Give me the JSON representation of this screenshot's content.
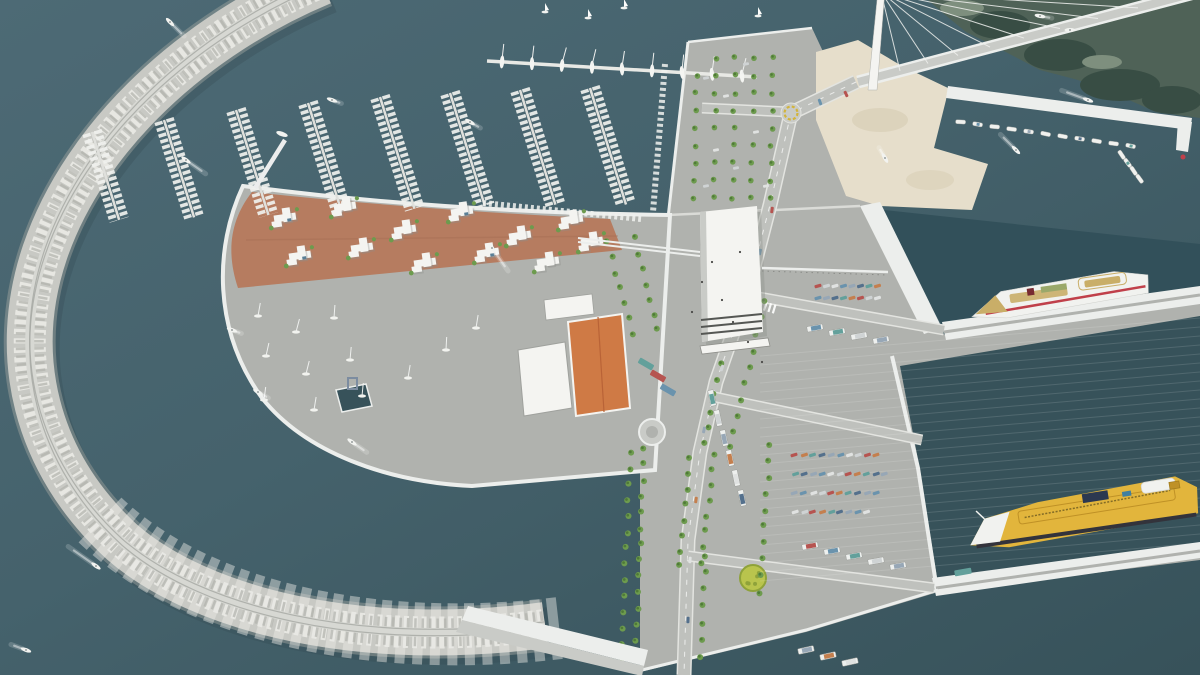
{
  "palette": {
    "water_top": "#4d6a75",
    "water_mid": "#45626c",
    "water_deep": "#37525a",
    "basin": "#32505a",
    "rock_light": "#eaeae6",
    "rock_mid": "#c8c9c4",
    "rock_dark": "#9aa09b",
    "crest": "#d7d8d3",
    "crest_line": "#a5a7a2",
    "quay_white": "#eceeec",
    "concrete": "#b0b2ae",
    "concrete_light": "#c9cbc7",
    "concrete_dark": "#9fa19d",
    "road": "#bfc1bd",
    "curb": "#e3e4e0",
    "sand": "#e6decb",
    "sand_shadow": "#d6cbb2",
    "plaza": "#b67c60",
    "plaza_dark": "#a16a50",
    "white_bld": "#f4f4f1",
    "bld_shadow": "#8f908b",
    "roof_orange": "#cf7a45",
    "roof_orange_dark": "#b96337",
    "tree": "#6d9b4e",
    "tree_dark": "#4f7a38",
    "coast": "#4f6257",
    "coast_dark": "#384d44",
    "coast_light": "#7e8f7e",
    "surf": "#e6eee8",
    "ferry_white": "#f1f2ef",
    "ferry_red": "#c0404a",
    "deck_tan": "#c9ae68",
    "funnel_dark": "#772b31",
    "yellow": "#e2b53c",
    "yellow_dark": "#bf9126",
    "hull_dark": "#33333b",
    "navy": "#2c3850",
    "pool": "#3f7fa0",
    "line_yellow": "#d2b43c",
    "grass": "#b9c44d",
    "grass_dark": "#8fa23a",
    "car_colors": [
      "#b65450",
      "#6a93ad",
      "#63a09b",
      "#cfd3d4",
      "#97a7b6",
      "#c47f4e",
      "#e0e2e1",
      "#54708c"
    ]
  },
  "scene": {
    "water_boats": [
      [
        170,
        22,
        225,
        16
      ],
      [
        332,
        100,
        200,
        6
      ],
      [
        186,
        160,
        215,
        20
      ],
      [
        470,
        122,
        210,
        8
      ],
      [
        492,
        248,
        235,
        24
      ],
      [
        232,
        330,
        200,
        6
      ],
      [
        258,
        392,
        210,
        8
      ],
      [
        352,
        442,
        215,
        14
      ],
      [
        96,
        566,
        35,
        30
      ],
      [
        26,
        650,
        20,
        12
      ],
      [
        1040,
        16,
        190,
        8
      ],
      [
        1070,
        30,
        0,
        0
      ],
      [
        1088,
        100,
        20,
        24
      ],
      [
        1016,
        150,
        45,
        18
      ],
      [
        885,
        158,
        60,
        8
      ]
    ],
    "sailboats": [
      [
        545,
        12
      ],
      [
        588,
        18
      ],
      [
        624,
        8
      ],
      [
        758,
        16
      ]
    ],
    "marina": {
      "dock": {
        "x1": 487,
        "y1": 61,
        "x2": 757,
        "y2": 77,
        "n": 9
      },
      "piers": [
        [
          92,
          132,
          92
        ],
        [
          164,
          120,
          102
        ],
        [
          236,
          110,
          110
        ],
        [
          308,
          103,
          114
        ],
        [
          380,
          97,
          117
        ],
        [
          450,
          93,
          118
        ],
        [
          520,
          90,
          120
        ],
        [
          590,
          88,
          122
        ]
      ],
      "moorings": [
        [
          483,
          203,
          641,
          219
        ],
        [
          665,
          64,
          653,
          212
        ]
      ],
      "entrance": [
        255,
        188,
        285,
        140
      ],
      "entrance_boat": [
        282,
        134,
        200,
        8
      ]
    },
    "bridge": {
      "deck": [
        858,
        82,
        1198,
        -8
      ],
      "cables": [
        900,
        928,
        958,
        990,
        1024,
        1060,
        1098,
        1138,
        1176
      ],
      "mast_top": [
        881,
        -8
      ]
    },
    "pavilions": [
      [
        285,
        218
      ],
      [
        345,
        207
      ],
      [
        405,
        230
      ],
      [
        462,
        212
      ],
      [
        520,
        236
      ],
      [
        572,
        220
      ],
      [
        300,
        256
      ],
      [
        362,
        248
      ],
      [
        425,
        263
      ],
      [
        488,
        253
      ],
      [
        548,
        262
      ],
      [
        592,
        242
      ]
    ],
    "boatyard": [
      [
        258,
        316
      ],
      [
        296,
        332
      ],
      [
        334,
        318
      ],
      [
        266,
        356
      ],
      [
        306,
        374
      ],
      [
        350,
        360
      ],
      [
        264,
        400
      ],
      [
        314,
        410
      ],
      [
        362,
        396
      ],
      [
        408,
        378
      ],
      [
        446,
        350
      ],
      [
        476,
        328
      ]
    ],
    "tree_rows": [
      [
        608,
        242,
        632,
        334,
        7
      ],
      [
        634,
        238,
        658,
        330,
        7
      ],
      [
        736,
        298,
        704,
        444,
        10
      ],
      [
        764,
        302,
        730,
        448,
        10
      ],
      [
        690,
        458,
        678,
        566,
        8
      ],
      [
        714,
        454,
        702,
        562,
        8
      ],
      [
        630,
        452,
        622,
        660,
        14
      ],
      [
        644,
        448,
        636,
        656,
        14
      ],
      [
        706,
        556,
        700,
        656,
        7
      ],
      [
        770,
        444,
        760,
        592,
        10
      ]
    ],
    "tree_grid": {
      "x0": 697,
      "y0": 58,
      "cols": 5,
      "dx": 19,
      "rows": 9,
      "dy": 17.5,
      "skew": -3
    },
    "cars": {
      "n_lot": {
        "x0": 818,
        "y0": 286,
        "dx": 8.5,
        "n": 8,
        "rows": 2,
        "rowdy": 12,
        "angle": -15
      },
      "s_lot": {
        "x0": 795,
        "y0": 455,
        "dx": 9,
        "counts": [
          10,
          11,
          10,
          9
        ],
        "rowdy": 19,
        "angle": -18
      },
      "strip": [
        [
          706,
          78
        ],
        [
          726,
          96
        ],
        [
          746,
          64
        ],
        [
          716,
          150
        ],
        [
          736,
          168
        ],
        [
          756,
          132
        ],
        [
          706,
          186
        ],
        [
          766,
          186
        ]
      ],
      "road": [
        [
          772,
          210,
          8
        ],
        [
          760,
          252,
          12
        ],
        [
          744,
          300,
          16
        ],
        [
          722,
          368,
          18
        ],
        [
          704,
          430,
          12
        ],
        [
          696,
          500,
          8
        ],
        [
          690,
          560,
          4
        ],
        [
          688,
          620,
          2
        ],
        [
          846,
          94,
          -25
        ],
        [
          820,
          102,
          -20
        ]
      ]
    },
    "trucks": {
      "rowA": [
        [
          815,
          328
        ],
        [
          837,
          332
        ],
        [
          859,
          336
        ],
        [
          881,
          340
        ]
      ],
      "col": [
        [
          712,
          398
        ],
        [
          718,
          418
        ],
        [
          724,
          438
        ],
        [
          730,
          458
        ],
        [
          736,
          478
        ],
        [
          742,
          498
        ]
      ],
      "rowS": [
        [
          810,
          546
        ],
        [
          832,
          551
        ],
        [
          854,
          556
        ],
        [
          876,
          561
        ],
        [
          898,
          566
        ]
      ],
      "bottom": [
        [
          806,
          650
        ],
        [
          828,
          656
        ],
        [
          850,
          662
        ]
      ],
      "busC": [
        [
          963,
          572
        ]
      ],
      "buses": [
        [
          658,
          376
        ],
        [
          668,
          390
        ],
        [
          646,
          364
        ]
      ]
    },
    "fishing": {
      "rows": [
        {
          "x1": 962,
          "y1": 112,
          "x2": 1132,
          "y2": 136,
          "n": 11,
          "off": 10
        },
        {
          "x1": 1128,
          "y1": 150,
          "x2": 1146,
          "y2": 174,
          "n": 4,
          "off": 8
        }
      ]
    },
    "ferries": {
      "f1": {
        "x": 1062,
        "y": 296,
        "a": -8
      },
      "f2": {
        "x": 1085,
        "y": 515,
        "a": -9
      }
    },
    "stripes": {
      "x0": 760,
      "y0": 356,
      "x1": 1200,
      "drop": -38,
      "dy": 9,
      "n": 26
    },
    "marks": {
      "roundabout_n": {
        "x": 791,
        "y": 113,
        "r": 10
      },
      "roundabout_s": {
        "x": 652,
        "y": 432,
        "r": 13
      },
      "grass_circle": {
        "x": 753,
        "y": 578,
        "r": 13
      },
      "zebra": {
        "x": 748,
        "y": 296,
        "n": 7,
        "dx": 4.4,
        "dy": 1.4
      }
    },
    "people": [
      [
        722,
        300
      ],
      [
        733,
        322
      ],
      [
        748,
        342
      ],
      [
        702,
        282
      ],
      [
        762,
        362
      ],
      [
        692,
        312
      ],
      [
        712,
        262
      ],
      [
        740,
        252
      ]
    ]
  }
}
